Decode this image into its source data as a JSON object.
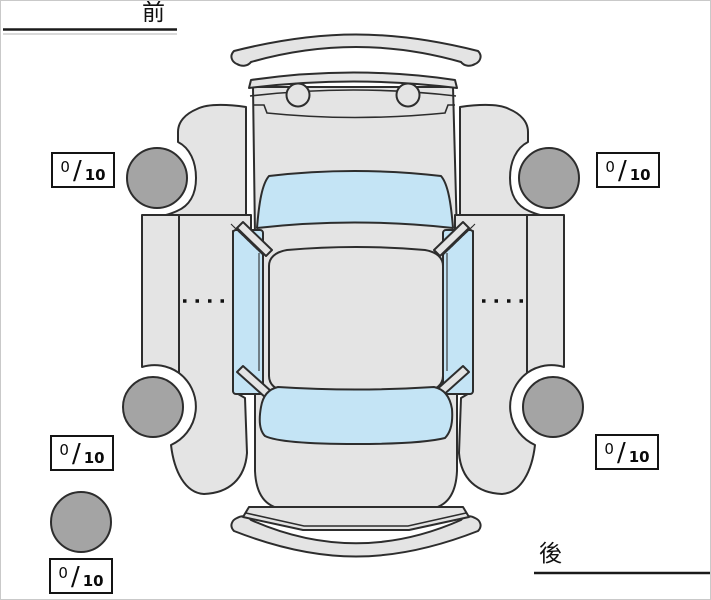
{
  "diagram_title": "tire-condition-top-view",
  "orientation": {
    "front_label": "前",
    "rear_label": "後"
  },
  "ratings": {
    "separator": "/",
    "front_left": {
      "score": "0",
      "max": "10"
    },
    "front_right": {
      "score": "0",
      "max": "10"
    },
    "rear_left": {
      "score": "0",
      "max": "10"
    },
    "rear_right": {
      "score": "0",
      "max": "10"
    },
    "spare": {
      "score": "0",
      "max": "10"
    }
  },
  "colors": {
    "body": "#e4e4e4",
    "window": "#c4e4f5",
    "tire": "#a4a4a4",
    "outline": "#2d2d2d"
  }
}
